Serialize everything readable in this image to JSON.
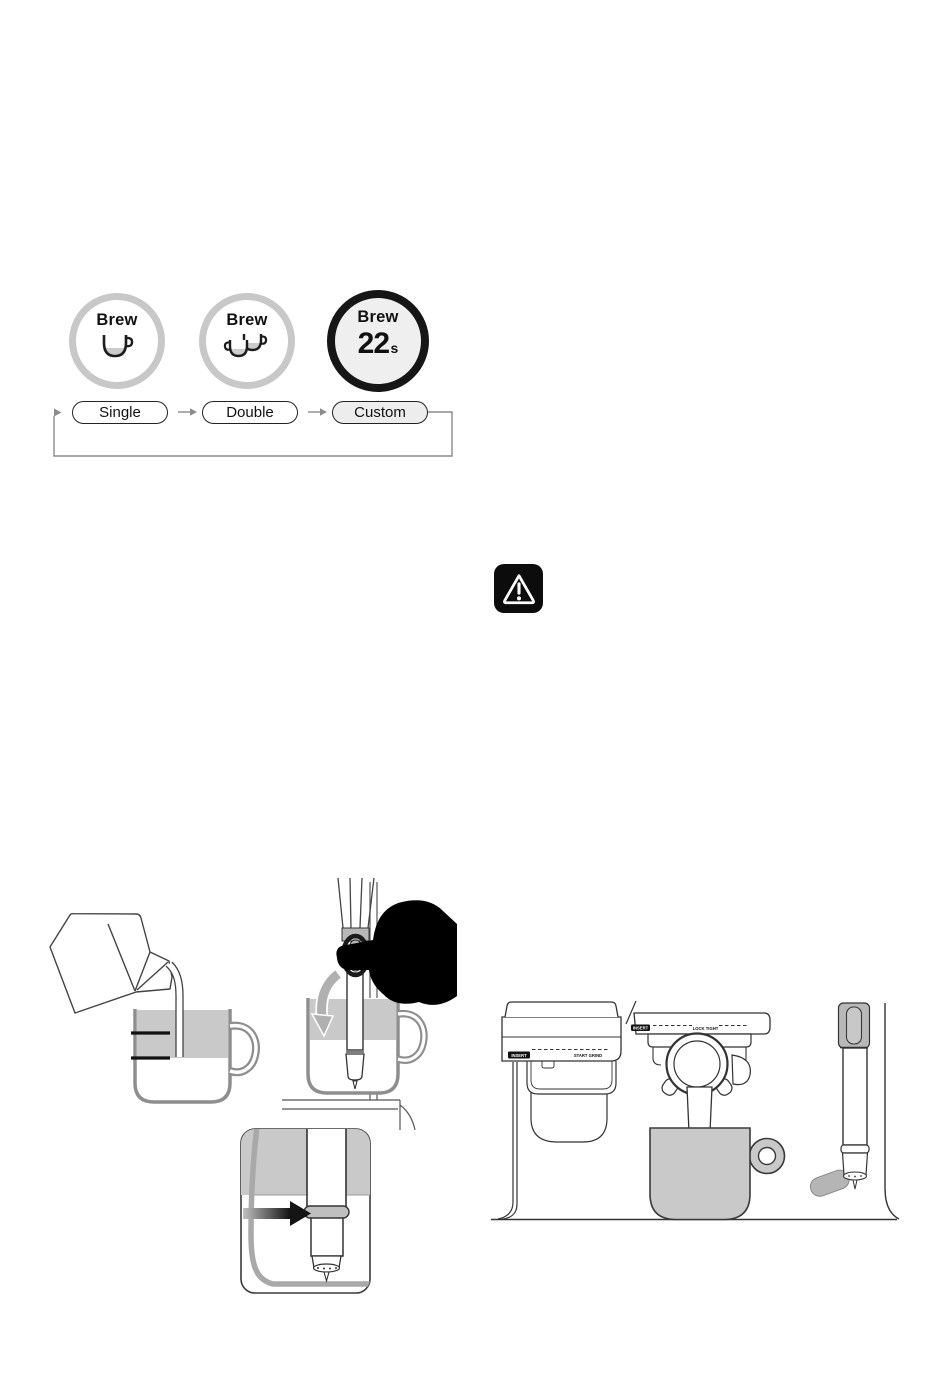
{
  "page": {
    "background": "#ffffff",
    "width": 950,
    "height": 1383
  },
  "brew_selector": {
    "buttons": [
      {
        "label": "Brew",
        "icon": "single-cup-icon"
      },
      {
        "label": "Brew",
        "icon": "double-cup-icon"
      },
      {
        "label": "Brew",
        "time_value": "22",
        "time_unit": "s",
        "active": true
      }
    ],
    "steps": [
      {
        "label": "Single",
        "selected": false
      },
      {
        "label": "Double",
        "selected": false
      },
      {
        "label": "Custom",
        "selected": true
      }
    ],
    "cycle_note": "steps cycle Single to Double to Custom and loop back"
  },
  "warning": {
    "icon": "warning-triangle-icon"
  },
  "machine_labels": {
    "grinder_insert": "INSERT",
    "grinder_action": "START GRIND",
    "grouphead_insert": "INSERT",
    "grouphead_action": "LOCK TIGHT"
  },
  "illustrations": [
    {
      "name": "pour-milk-into-jug"
    },
    {
      "name": "lower-steam-wand-into-jug"
    },
    {
      "name": "steam-wand-depth-closeup"
    },
    {
      "name": "grinder-grouphead-steamwand-machine-views"
    }
  ],
  "colors": {
    "inactive_ring": "#c8c8c8",
    "active_ring": "#161616",
    "selected_pill_fill": "#ededed",
    "milk_gray": "#c9c9c9",
    "flow_line_gray": "#8c8c8c",
    "ink": "#1a1a1a"
  }
}
